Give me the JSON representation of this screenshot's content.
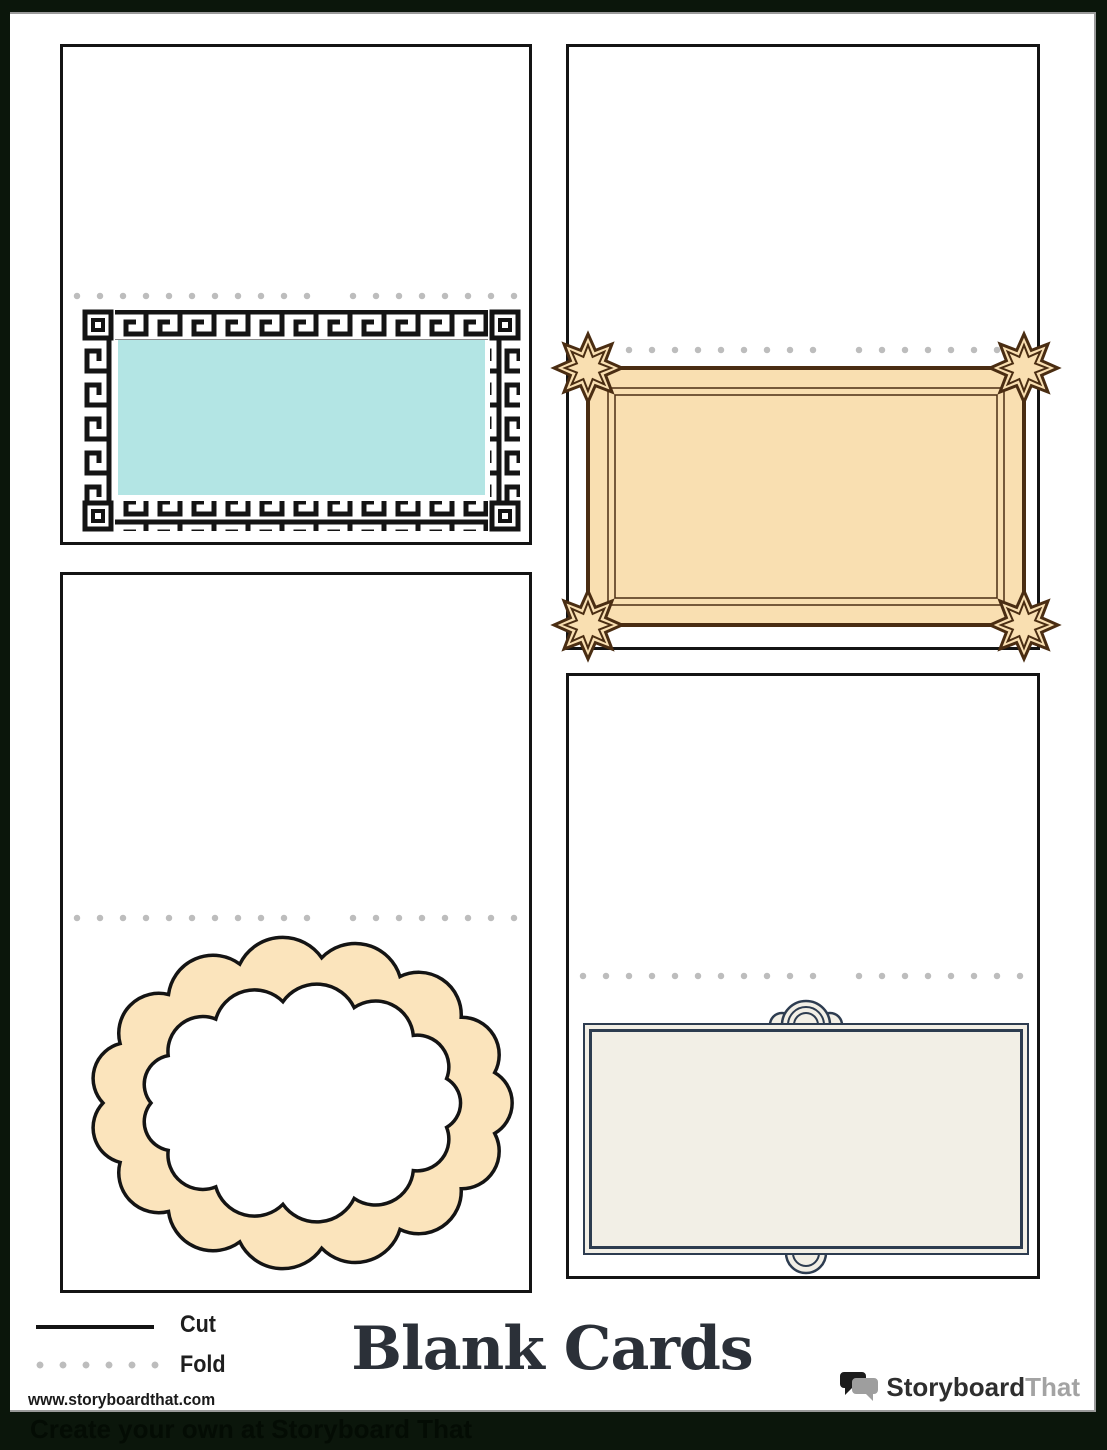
{
  "title": "Blank Cards",
  "website": "www.storyboardthat.com",
  "legend": {
    "cut_label": "Cut",
    "fold_label": "Fold"
  },
  "logo": {
    "brand_primary": "Storyboard",
    "brand_secondary": "That"
  },
  "footer_text": "Create your own at Storyboard That",
  "cards": [
    {
      "name": "greek-key-card",
      "frame": "greek-key-border",
      "frame_fill": "#b3e5e4"
    },
    {
      "name": "art-deco-card",
      "frame": "art-deco-star-corner-border",
      "frame_fill": "#f9dfb1"
    },
    {
      "name": "scallop-card",
      "frame": "scalloped-cloud-border",
      "frame_fill": "#fbe4bc"
    },
    {
      "name": "classic-card",
      "frame": "double-line-arch-border",
      "frame_fill": "#f2efe6"
    }
  ],
  "colors": {
    "ink": "#141414",
    "dot": "#bdbdbd",
    "teal": "#b3e5e4",
    "deco_fill": "#f9dfb1",
    "deco_line": "#4a2d12",
    "scallop_fill": "#fbe4bc",
    "navy": "#2d3c50",
    "navy_fill": "#f2efe6",
    "outer_bg": "#0b160b",
    "page_bg": "#ffffff",
    "title_ink": "#2b3038",
    "logo_gray": "#a3a3a3",
    "footer_ink": "#040c04"
  }
}
